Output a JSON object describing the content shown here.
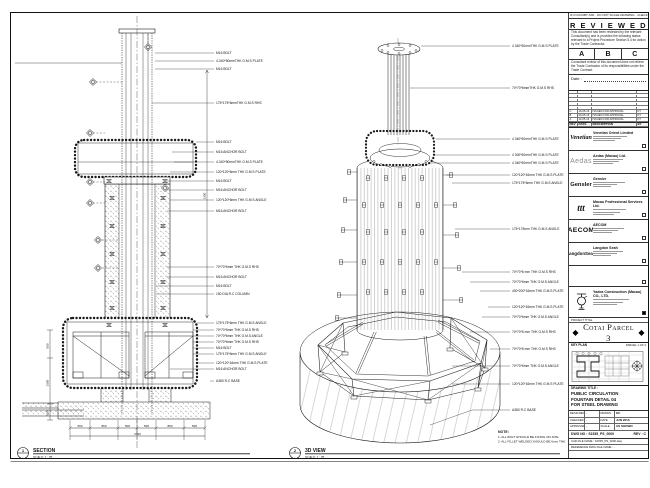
{
  "sheet": {
    "note": {
      "title": "NOTE:",
      "lines": [
        "1. ALL BOLT SHOULD BE FIXING ON SITE.",
        "2. ALL FILLET WELDED SHOULD BE 6mm THK."
      ]
    },
    "section_view": {
      "bubble_num": "1",
      "bubble_ref": "-",
      "title": "SECTION",
      "scale": "SCALE 1 : 25",
      "callouts": [
        "M16 BOLT",
        "4-340*50mmTHK G.M.S PLATE",
        "M16 BOLT",
        "175*175*6mmTHK G.M.S RHS",
        "M16 BOLT",
        "M16 ANCHOR BOLT",
        "4-340*50mmTHK G.M.S PLATE",
        "120*120*6mm THK G.M.S PLATE",
        "M16 BOLT",
        "M16 ANCHOR BOLT",
        "120*120*6mm THK G.M.S ANGLE",
        "M16 ANCHOR BOLT",
        "70*70*6mm THK G.M.S RHS",
        "M16 ANCHOR BOLT",
        "M16 BOLT",
        "150 DIA R.C COLUMN",
        "175*175*6mm THK G.M.S ANGLE",
        "70*70*6mm THK G.M.S RHS",
        "70*70*6mm THK G.M.S ANGLE",
        "70*70*6mm THK G.M.S RHS",
        "M16 BOLT",
        "175*175*6mm THK G.M.S ANGLE",
        "120*120*16mm THK G.M.S PLATE",
        "M16 ANCHOR BOLT",
        "A380 R.C BASE"
      ],
      "dims_bottom": [
        "500",
        "860",
        "500",
        "500",
        "860",
        "500"
      ],
      "dims_bottom_total": "3720",
      "dims_left": [
        "500",
        "1500",
        "500"
      ],
      "dim_right": "3300"
    },
    "iso_view": {
      "bubble_num": "2",
      "bubble_ref": "-",
      "title": "3D VIEW",
      "scale": "SCALE 1 : 25",
      "callouts": [
        "4 340*50mmTHK G.M.S PLATE",
        "70*70*6mmTHK G.M.S RHS",
        "4 340*50mmTHK G.M.S PLATE",
        "4 300*50mmTHK G.M.S PLATE",
        "4 340*50mmTHK G.M.S PLATE",
        "120*120*16mm THK G.M.S PLATE",
        "175*175*6mm THK G.M.S ANGLE",
        "175*175mm THK G.M.S ANGLE",
        "70*70*6 mm THK G.M.S RHS",
        "70*70*6mm THK G.M.S ANGLE",
        "400*200*16mm THK G.M.S PLATE",
        "120*120*16mm THK G.M.S PLATE",
        "70*70*6mm THK G.M.S ANGLE",
        "70*70*6 mm THK G.M.S RHS",
        "70*70*6 mm THK G.M.S RHS",
        "70*70*6mm THK G.M.S ANGLE",
        "120*120*16mm THK G.M.S PLATE",
        "A380 R.C BASE"
      ]
    }
  },
  "stamp": {
    "strip": "IF IN DOUBT ASK · DO NOT SCALE DRAWING · CHECK ALL DIMENSIONS ON SITE",
    "title": "R E V I E W E D",
    "para1": "This document has been reviewed by the relevant Consultant(s) and is provided the following status relevant to a Project Procedure Section 5.4 for action by the Trade Contractor.",
    "options": [
      "A",
      "B",
      "C"
    ],
    "para2": "Consultant review of this document does not relieve the Trade Contractor of its responsibilities under the Trade Contract.",
    "date_label": "Date :"
  },
  "revisions": {
    "headers": [
      "REV",
      "DATE",
      "DESCRIPTION",
      "BY"
    ],
    "rows": [
      {
        "rev": "C",
        "date": "10-06-16",
        "desc": "ISSUED FOR APPROVAL",
        "by": "KT"
      },
      {
        "rev": "B",
        "date": "26-05-16",
        "desc": "ISSUED FOR APPROVAL",
        "by": "KT"
      },
      {
        "rev": "A",
        "date": "12-05-16",
        "desc": "ISSUED FOR APPROVAL",
        "by": "KT"
      }
    ]
  },
  "consultants": [
    {
      "logo_text": "Venetian",
      "name": "Venetian Orient Limited"
    },
    {
      "logo_text": "Aedas",
      "name": "Aedas (Macau) Ltd."
    },
    {
      "logo_text": "Gensler",
      "name": "Gensler"
    },
    {
      "logo_text": "ttt",
      "name": "Macau Professional Services Ltd."
    },
    {
      "logo_text": "AECOM",
      "name": "AECOM"
    },
    {
      "logo_text": "LangdonSeah",
      "name": "Langdon Seah"
    }
  ],
  "contractor": {
    "name": "Yadea Construction (Macau) CO., LTD."
  },
  "project": {
    "band_label": "PROJECT TITLE",
    "name": "Cotai Parcel 3"
  },
  "key_plan": {
    "label": "KEY PLAN",
    "parcel": "PARCEL 1 OF 3"
  },
  "title_block": {
    "drawing_title_label": "DRAWING TITLE :",
    "title_lines": [
      "PUBLIC CIRCULATION",
      "FOUNTAIN DETAIL 04",
      "FOR STEEL DRAWING"
    ],
    "fields": [
      {
        "label": "DESIGNED",
        "value": "-",
        "label2": "DRAWN",
        "value2": "KC"
      },
      {
        "label": "CHECKED",
        "value": "-",
        "label2": "DATE",
        "value2": "JUN 2016"
      },
      {
        "label": "APPROVED",
        "value": "-",
        "label2": "SCALE",
        "value2": "AS SHOWN"
      }
    ],
    "dwg_no_label": "DWG NO :",
    "dwg_no": "S1535_PS_0000",
    "rev_label": "REV :",
    "rev": "C",
    "cad_label": "CAD FILE NAME :",
    "cad_value": "S1535_PS_0000.dwg",
    "ref_label": "REFERENCE DWG FILE NAME :",
    "ref_value": "-"
  }
}
